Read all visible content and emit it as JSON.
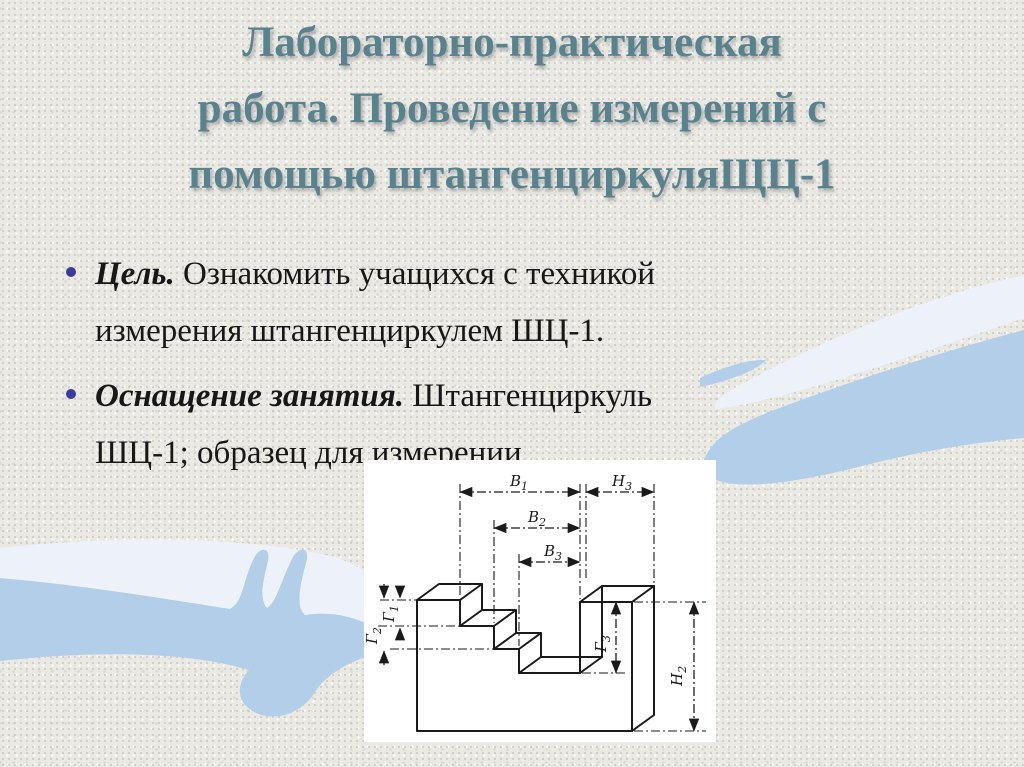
{
  "title": {
    "text": "Лабораторно-практическая работа. Проведение измерений с помощью штангенциркуляЩЦ-1",
    "lines": [
      "Лабораторно-практическая",
      "работа. Проведение измерений с",
      "помощью штангенциркуляЩЦ-1"
    ]
  },
  "bullets": [
    {
      "lines": [
        {
          "lead": "Цель.",
          "text": " Ознакомить учащихся с техникой"
        },
        {
          "lead": "",
          "text": "измерения штангенциркулем ШЦ-1."
        }
      ]
    },
    {
      "lines": [
        {
          "lead": "Оснащение занятия.",
          "text": " Штангенциркуль"
        },
        {
          "lead": "",
          "text": "ШЦ-1; образец для измерении"
        }
      ]
    }
  ],
  "drawing": {
    "labels": {
      "b1": {
        "base": "В",
        "sub": "1"
      },
      "b2": {
        "base": "В",
        "sub": "2"
      },
      "b3": {
        "base": "В",
        "sub": "3"
      },
      "h3": {
        "base": "Н",
        "sub": "3"
      },
      "g1": {
        "base": "Г",
        "sub": "1"
      },
      "g2": {
        "base": "Г",
        "sub": "2"
      },
      "g3": {
        "base": "Г",
        "sub": "3"
      },
      "h2": {
        "base": "Н",
        "sub": "2"
      }
    }
  },
  "colors": {
    "title": "#59828f",
    "body_text": "#171717",
    "bullet_dot": "#3c3c9e",
    "hand_blue": "#b3cee9",
    "hand_pale": "#edf2fa",
    "background": "#eae9e4",
    "drawing_line": "#1a1a1a",
    "panel_background": "#ffffff"
  }
}
